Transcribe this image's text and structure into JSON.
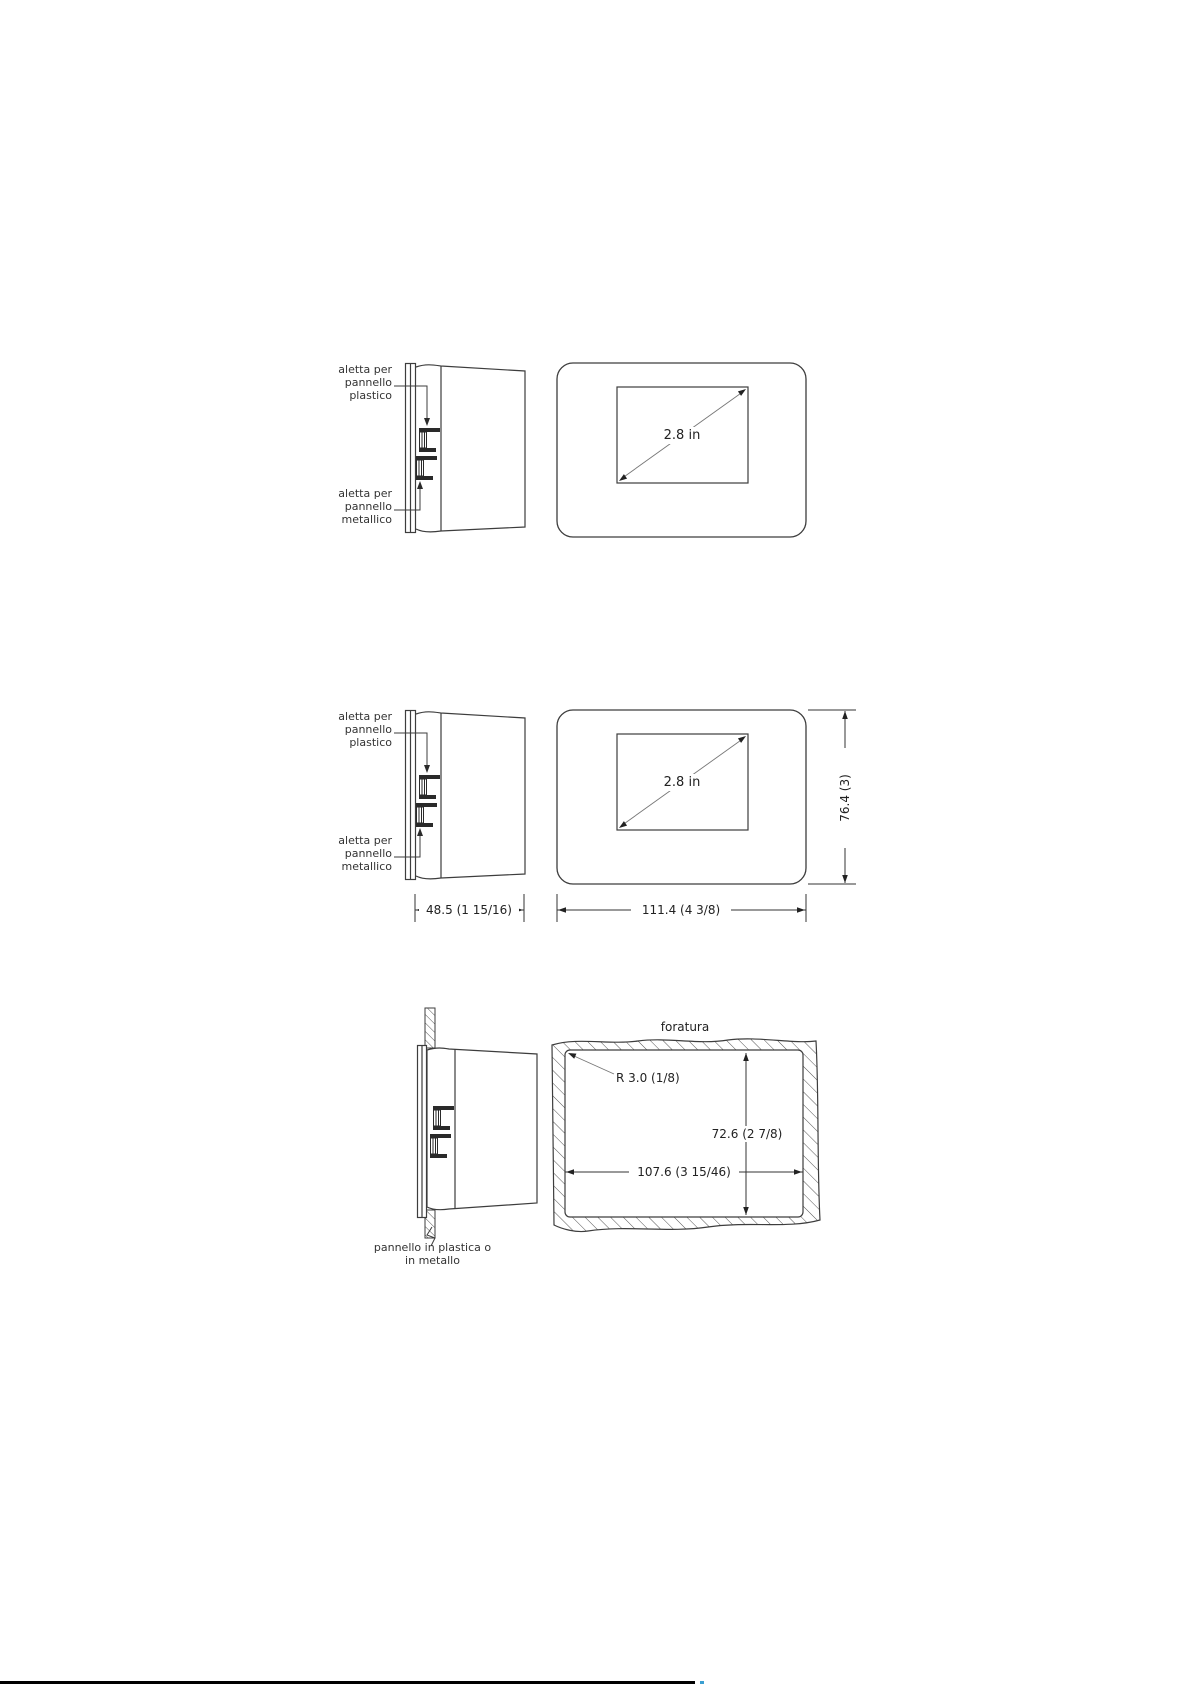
{
  "top_view": {
    "clip_plastic_label": "aletta per\npannello\nplastico",
    "clip_metal_label": "aletta per\npannello\nmetallico",
    "display_size": "2.8 in"
  },
  "dimensioned_view": {
    "clip_plastic_label": "aletta per\npannello\nplastico",
    "clip_metal_label": "aletta per\npannello\nmetallico",
    "display_size": "2.8 in",
    "height_dim": "76.4 (3)",
    "depth_dim": "48.5 (1 15/16)",
    "width_dim": "111.4 (4 3/8)"
  },
  "cutout_view": {
    "cutout_label": "foratura",
    "corner_radius_dim": "R 3.0 (1/8)",
    "height_dim": "72.6 (2 7/8)",
    "width_dim": "107.6 (3 15/46)",
    "panel_label": "pannello in plastica o\nin metallo"
  }
}
